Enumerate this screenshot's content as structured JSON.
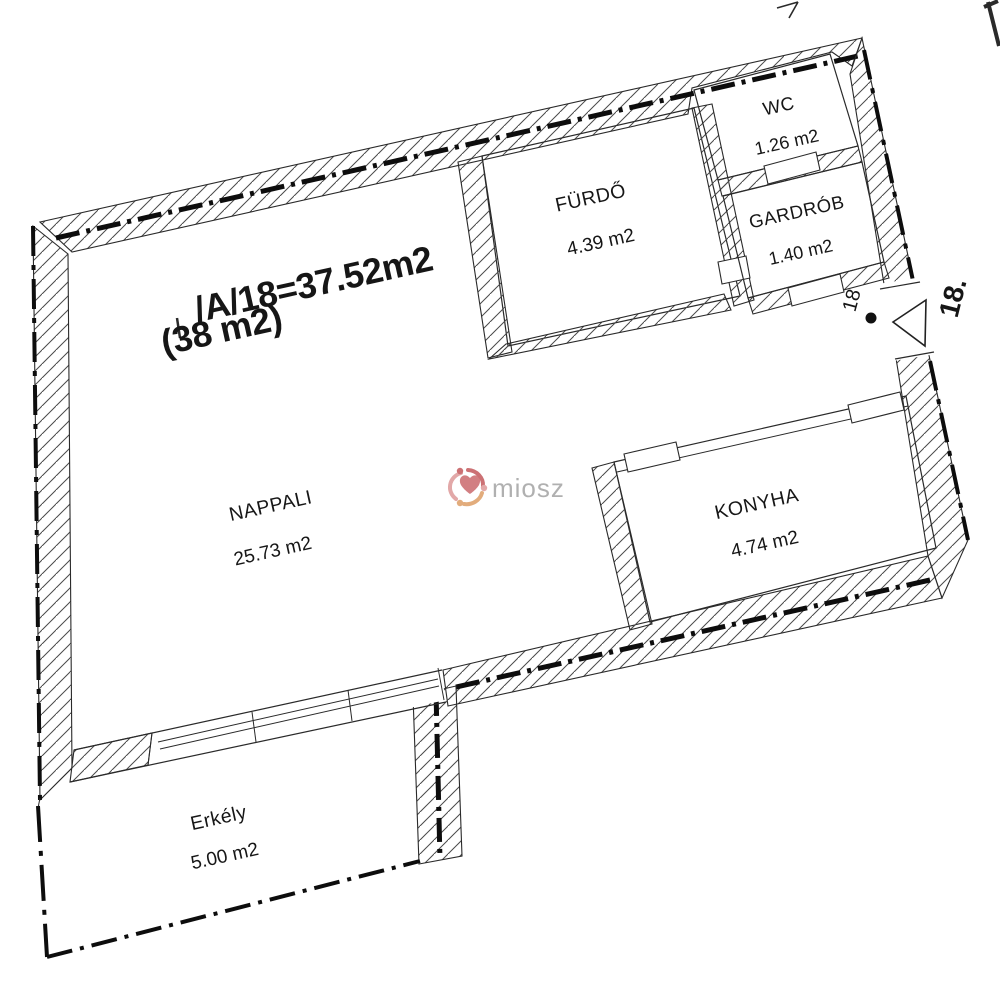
{
  "title": {
    "line1": "/A/18=37.52m2",
    "line2": "(38 m2)"
  },
  "rooms": [
    {
      "name": "NAPPALI",
      "area": "25.73 m2"
    },
    {
      "name": "FÜRDŐ",
      "area": "4.39 m2"
    },
    {
      "name": "WC",
      "area": "1.26 m2"
    },
    {
      "name": "GARDRÓB",
      "area": "1.40 m2"
    },
    {
      "name": "KONYHA",
      "area": "4.74 m2"
    },
    {
      "name": "Erkély",
      "area": "5.00 m2"
    }
  ],
  "entrance": {
    "unit_number_inside": "18",
    "unit_number_outside": "18."
  },
  "watermark": {
    "text": "miosz",
    "text_color": "#a3a3a3",
    "logo_red": "#c4595c",
    "logo_pink": "#dd9999",
    "logo_orange": "#dd9e66"
  },
  "colors": {
    "line": "#161616",
    "background": "#ffffff"
  }
}
